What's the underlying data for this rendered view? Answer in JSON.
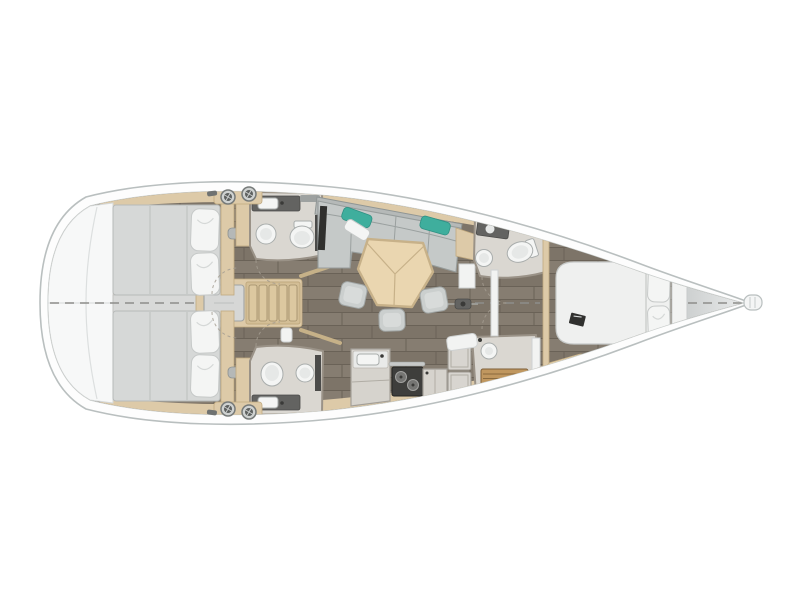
{
  "figure_alt": "Top-view interior floor plan of a sailing yacht: two aft double cabins with en-suite heads, central companionway stairs, saloon with U-shaped sofa and hexagonal table, galley, forward head and separate shower, and forward owner cabin with island bed",
  "colors": {
    "hull_line": "#b9bfbf",
    "inner_line": "#cbd0cf",
    "deck_white": "#fdfdfd",
    "transom": "#f7f8f8",
    "floor_light": "#867d71",
    "floor_dark": "#7d7468",
    "floor_seam": "#6a6257",
    "walkway": "#d8d9d8",
    "wood_tan": "#ddcaa8",
    "wood_dark": "#c0a97f",
    "stairs": "#d3be96",
    "mattress": "#d6d8d7",
    "pillow": "#f4f5f4",
    "bed_white": "#eff0ef",
    "sofa": "#c5c9c8",
    "teal": "#3fae9d",
    "table": "#ead6b0",
    "table_edge": "#c7b189",
    "stool": "#cbcfce",
    "bath_floor": "#dad7d1",
    "bath_wall": "#9a9287",
    "counter_dark": "#636361",
    "fixture": "#f4f5f4",
    "stove": "#3e3e3c",
    "teak": "#c0975f",
    "tv_dark": "#30302e",
    "bow_deck_from": "#cdd0d0",
    "bow_deck_to": "#e9ebeb"
  },
  "areas": {
    "aft_cabin_top": "aft double cabin",
    "aft_cabin_bottom": "aft double cabin",
    "aft_head_top": "aft head (toilet + basin)",
    "aft_head_bottom": "aft head (toilet + basin)",
    "companionway": "companionway stairs + engine box",
    "saloon": "saloon with sofa, table and stools",
    "galley": "galley with sink and stove",
    "fwd_head": "forward head",
    "fwd_shower": "forward shower with teak grate",
    "fwd_cabin": "forward owner cabin with island bed",
    "bow_deck": "bow deck",
    "stern_platform": "stern transom platform"
  }
}
